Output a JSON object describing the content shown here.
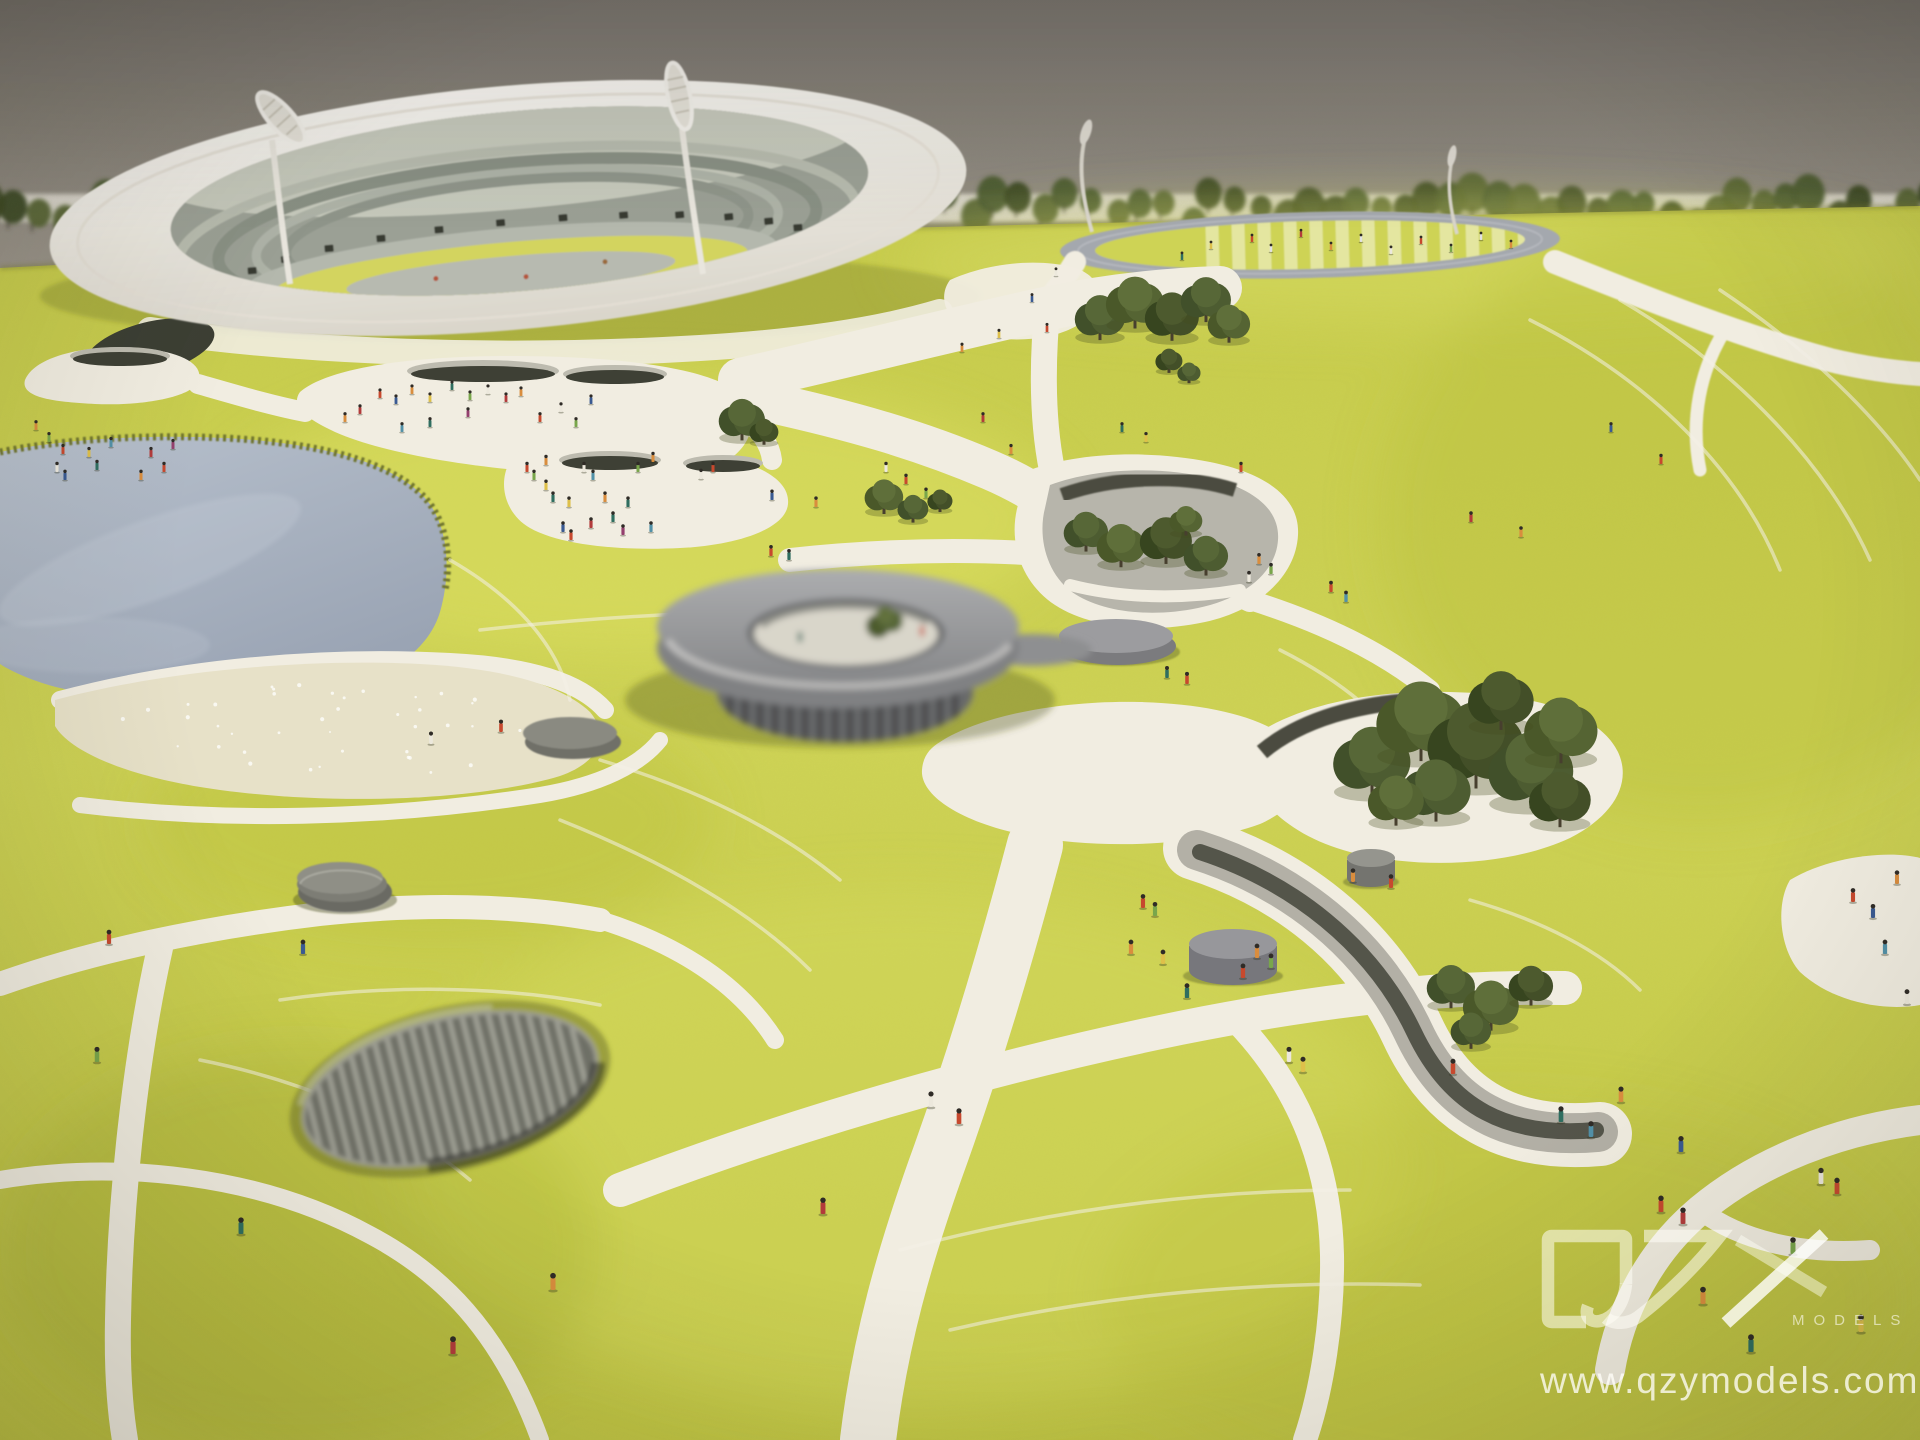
{
  "meta": {
    "description": "Photograph of a physical architectural scale model: white ring stadium, athletics track, chartreuse felt park landscape with white paths, lake, beach, sunken walkways, gray disc pavilions, miniature trees and figures, on a table against a gray wall",
    "alt": "Stadium park architectural scale model photo"
  },
  "watermark": {
    "brand": "QZY",
    "brand_sub": "MODELS",
    "url": "www.qzymodels.com"
  },
  "colors": {
    "wall1": "#7e7972",
    "wall2": "#9a948b",
    "base": "#dad6cd",
    "grass": "#cbd04f",
    "grass_light": "#dde163",
    "grass_shadow": "#aeb338",
    "path": "#f1ede1",
    "lake": "#a9b2c1",
    "beach": "#e7e1c8",
    "white": "#f2efe9",
    "structure": "#8b8b8d",
    "structure_dark": "#5c5d5e",
    "tree": "#4d5c31",
    "wm": "rgba(255,254,248,0.58)"
  },
  "scene": {
    "figure_palette": [
      "#c7492e",
      "#d98d3e",
      "#2f6e60",
      "#ece8dc",
      "#3a5a92",
      "#79a64b",
      "#b23b3b",
      "#dec04a",
      "#94406e",
      "#5291a8",
      "#e2e2e2"
    ],
    "tree_palettes": [
      [
        "#4a5829",
        "#556433",
        "#5f6f3a"
      ],
      [
        "#41502a",
        "#4d5c31",
        "#576737"
      ],
      [
        "#37451f",
        "#434f28",
        "#4d5a2e"
      ]
    ],
    "hedge_shades": [
      "#3f4c27",
      "#4a5830",
      "#556334",
      "#3a4724"
    ],
    "beach_sparkle_count": 40,
    "trees": [
      [
        1100,
        318,
        26,
        1
      ],
      [
        1135,
        303,
        30,
        0
      ],
      [
        1172,
        317,
        28,
        2
      ],
      [
        1206,
        300,
        26,
        1
      ],
      [
        1229,
        324,
        22,
        0
      ],
      [
        742,
        420,
        24,
        1
      ],
      [
        764,
        432,
        15,
        2
      ],
      [
        884,
        497,
        20,
        0
      ],
      [
        913,
        509,
        16,
        1
      ],
      [
        940,
        501,
        13,
        2
      ],
      [
        1086,
        532,
        23,
        1
      ],
      [
        1121,
        546,
        25,
        0
      ],
      [
        1166,
        541,
        27,
        2
      ],
      [
        1206,
        556,
        23,
        1
      ],
      [
        1186,
        521,
        17,
        0
      ],
      [
        1169,
        361,
        14,
        2
      ],
      [
        1189,
        373,
        12,
        1
      ],
      [
        1372,
        762,
        40,
        1
      ],
      [
        1421,
        722,
        46,
        0
      ],
      [
        1476,
        746,
        50,
        2
      ],
      [
        1531,
        771,
        44,
        1
      ],
      [
        1561,
        731,
        38,
        0
      ],
      [
        1501,
        701,
        34,
        2
      ],
      [
        1436,
        791,
        36,
        1
      ],
      [
        1396,
        801,
        29,
        0
      ],
      [
        1560,
        800,
        32,
        2
      ],
      [
        1451,
        987,
        25,
        1
      ],
      [
        1491,
        1006,
        29,
        0
      ],
      [
        1531,
        986,
        23,
        2
      ],
      [
        1471,
        1031,
        21,
        1
      ]
    ],
    "figures": [
      [
        380,
        398,
        0
      ],
      [
        396,
        404,
        4
      ],
      [
        412,
        394,
        1
      ],
      [
        430,
        402,
        7
      ],
      [
        452,
        390,
        2
      ],
      [
        470,
        400,
        5
      ],
      [
        488,
        394,
        3
      ],
      [
        506,
        402,
        6
      ],
      [
        521,
        396,
        1
      ],
      [
        468,
        417,
        8
      ],
      [
        430,
        427,
        2
      ],
      [
        402,
        432,
        9
      ],
      [
        540,
        422,
        0
      ],
      [
        561,
        412,
        3
      ],
      [
        576,
        427,
        5
      ],
      [
        360,
        414,
        6
      ],
      [
        345,
        422,
        1
      ],
      [
        591,
        404,
        4
      ],
      [
        527,
        472,
        0
      ],
      [
        534,
        480,
        5
      ],
      [
        546,
        465,
        1
      ],
      [
        553,
        502,
        2
      ],
      [
        569,
        507,
        7
      ],
      [
        584,
        472,
        3
      ],
      [
        593,
        480,
        9
      ],
      [
        605,
        502,
        1
      ],
      [
        563,
        532,
        4
      ],
      [
        571,
        540,
        0
      ],
      [
        591,
        528,
        6
      ],
      [
        613,
        522,
        2
      ],
      [
        623,
        535,
        8
      ],
      [
        638,
        472,
        5
      ],
      [
        653,
        462,
        1
      ],
      [
        701,
        479,
        3
      ],
      [
        713,
        472,
        0
      ],
      [
        546,
        490,
        7
      ],
      [
        628,
        507,
        2
      ],
      [
        651,
        532,
        9
      ],
      [
        772,
        500,
        4
      ],
      [
        816,
        507,
        1
      ],
      [
        36,
        430,
        1
      ],
      [
        49,
        442,
        5
      ],
      [
        63,
        454,
        0
      ],
      [
        57,
        472,
        3
      ],
      [
        89,
        457,
        7
      ],
      [
        97,
        470,
        2
      ],
      [
        111,
        447,
        9
      ],
      [
        65,
        480,
        4
      ],
      [
        151,
        457,
        6
      ],
      [
        164,
        472,
        0
      ],
      [
        173,
        449,
        8
      ],
      [
        141,
        480,
        1
      ],
      [
        1252,
        242,
        0
      ],
      [
        1271,
        252,
        10
      ],
      [
        1301,
        237,
        6
      ],
      [
        1331,
        250,
        1
      ],
      [
        1361,
        242,
        10
      ],
      [
        1391,
        254,
        3
      ],
      [
        1421,
        244,
        0
      ],
      [
        1451,
        252,
        5
      ],
      [
        1481,
        240,
        10
      ],
      [
        1182,
        260,
        2
      ],
      [
        1211,
        249,
        7
      ],
      [
        1511,
        248,
        1
      ],
      [
        1032,
        302,
        4
      ],
      [
        1047,
        332,
        0
      ],
      [
        983,
        422,
        6
      ],
      [
        1011,
        454,
        1
      ],
      [
        886,
        472,
        3
      ],
      [
        906,
        484,
        0
      ],
      [
        926,
        498,
        5
      ],
      [
        962,
        352,
        1
      ],
      [
        999,
        338,
        7
      ],
      [
        1056,
        276,
        3
      ],
      [
        1122,
        432,
        2
      ],
      [
        1146,
        442,
        7
      ],
      [
        1241,
        472,
        0
      ],
      [
        1259,
        564,
        1
      ],
      [
        1271,
        574,
        5
      ],
      [
        1249,
        582,
        3
      ],
      [
        1331,
        592,
        0
      ],
      [
        1346,
        602,
        9
      ],
      [
        1471,
        522,
        6
      ],
      [
        1521,
        537,
        1
      ],
      [
        1611,
        432,
        4
      ],
      [
        1661,
        464,
        0
      ],
      [
        1167,
        678,
        2
      ],
      [
        1187,
        684,
        0
      ],
      [
        1257,
        958,
        1
      ],
      [
        1271,
        968,
        5
      ],
      [
        1243,
        978,
        0
      ],
      [
        1289,
        1062,
        3
      ],
      [
        1303,
        1072,
        7
      ],
      [
        1453,
        1074,
        0
      ],
      [
        1561,
        1122,
        2
      ],
      [
        1591,
        1137,
        9
      ],
      [
        1621,
        1102,
        1
      ],
      [
        1681,
        1152,
        4
      ],
      [
        1661,
        1212,
        0
      ],
      [
        1683,
        1224,
        6
      ],
      [
        1703,
        1304,
        1
      ],
      [
        1821,
        1184,
        3
      ],
      [
        1837,
        1194,
        0
      ],
      [
        1793,
        1254,
        5
      ],
      [
        1751,
        1352,
        2
      ],
      [
        1861,
        1332,
        7
      ],
      [
        1853,
        902,
        0
      ],
      [
        1873,
        918,
        4
      ],
      [
        1897,
        884,
        1
      ],
      [
        1885,
        954,
        9
      ],
      [
        1907,
        1004,
        3
      ],
      [
        1143,
        908,
        0
      ],
      [
        1155,
        916,
        5
      ],
      [
        1131,
        954,
        1
      ],
      [
        1163,
        964,
        7
      ],
      [
        1187,
        998,
        2
      ],
      [
        931,
        1107,
        3
      ],
      [
        959,
        1124,
        0
      ],
      [
        823,
        1214,
        6
      ],
      [
        1353,
        882,
        1
      ],
      [
        1391,
        888,
        0
      ],
      [
        109,
        944,
        0
      ],
      [
        303,
        954,
        4
      ],
      [
        553,
        1290,
        1
      ],
      [
        453,
        1354,
        6
      ],
      [
        241,
        1234,
        2
      ],
      [
        431,
        744,
        3
      ],
      [
        501,
        732,
        0
      ],
      [
        97,
        1062,
        5
      ],
      [
        789,
        560,
        2
      ],
      [
        771,
        556,
        0
      ]
    ]
  }
}
